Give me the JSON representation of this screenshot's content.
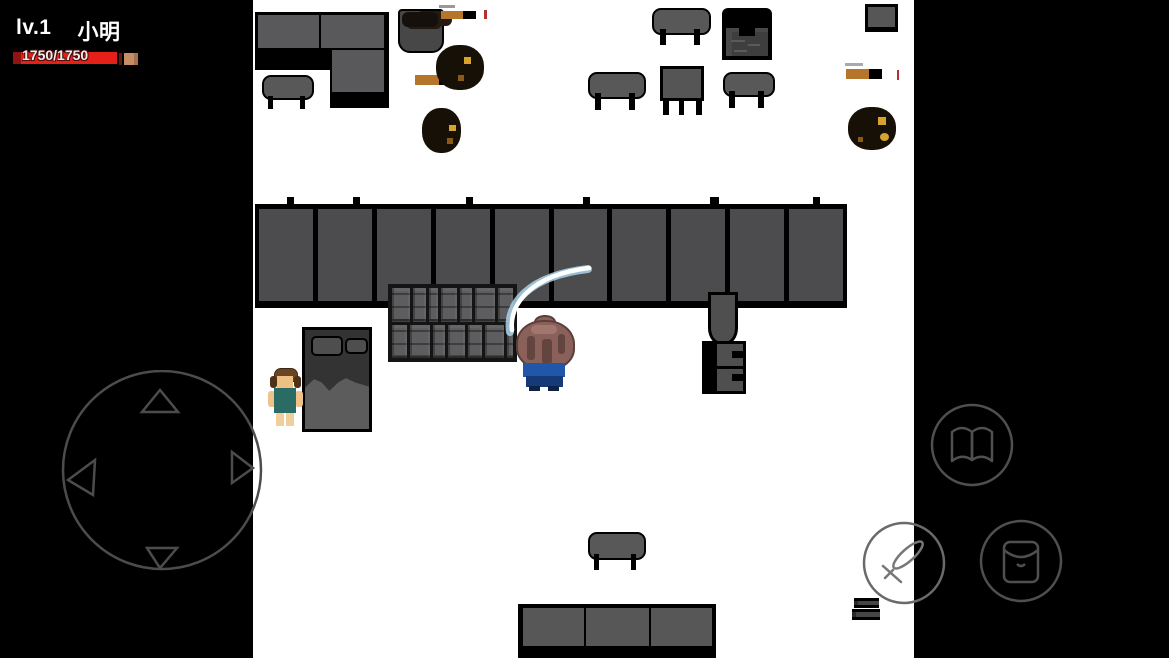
{
  "hud": {
    "level": "lv.1",
    "player_name": "小明",
    "hp_display": "1750/1750",
    "hp_current": 1750,
    "hp_max": 1750,
    "hp_color": "#e42019"
  },
  "controls": {
    "joystick": {
      "directions": [
        "up",
        "left",
        "right",
        "down"
      ],
      "style": "outlined circle with four arrow triangles"
    },
    "buttons": [
      {
        "id": "book",
        "icon": "book-icon",
        "purpose": "open book / skills"
      },
      {
        "id": "attack",
        "icon": "sword-icon",
        "purpose": "attack"
      },
      {
        "id": "bag",
        "icon": "bag-icon",
        "purpose": "inventory"
      }
    ]
  },
  "scene": {
    "background": "#ffffff",
    "letterbox": "#000000",
    "objects": [
      "l-shaped-kitchen-counter",
      "stool",
      "cooking-pot-with-stew",
      "frying-pan-handle",
      "burnt-food-pile",
      "bench",
      "square-table",
      "stove-chest",
      "picture-frame",
      "tiled-wall",
      "stone-crate-pile",
      "bed-with-pillows",
      "npc-villager",
      "player-character",
      "sword-slash-effect",
      "wall-chair",
      "drawer-cabinet",
      "bottom-bench",
      "bottom-counter-row",
      "book-stack"
    ],
    "effects": [
      "white-blue sword slash arc above player"
    ]
  },
  "colors": {
    "wall_panel": "#4c4c4e",
    "furniture_gray": "#59595b",
    "pan_handle_tan": "#b5762b",
    "player_hair": "#8a615a",
    "player_shirt": "#2157a8",
    "npc_shirt": "#2a6b63",
    "food_speck_gold": "#d8a32c"
  }
}
